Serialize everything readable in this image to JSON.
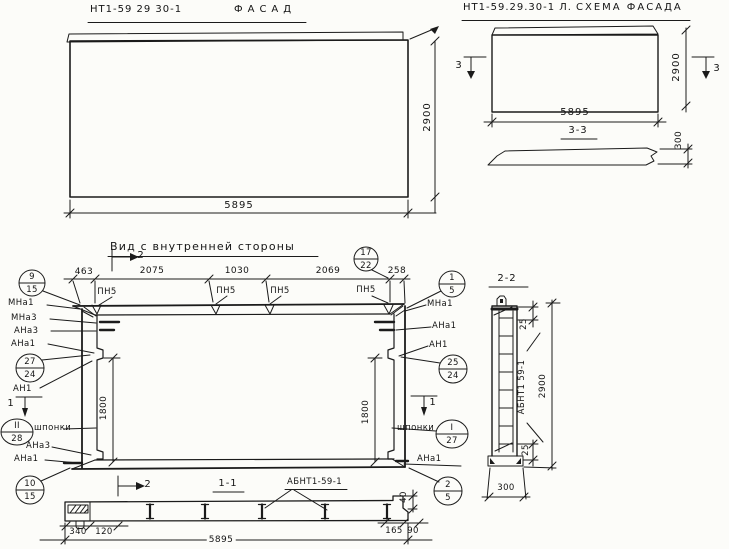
{
  "facade": {
    "code": "НТ1-59 29 30-1",
    "title": "ФАСАД",
    "width": "5895",
    "height": "2900"
  },
  "schema": {
    "code": "НТ1-59.29.30-1 Л.",
    "title": "СХЕМА ФАСАДА",
    "width": "5895",
    "height": "2900",
    "thickness": "300",
    "marker": "3",
    "section_title": "3-3"
  },
  "inner": {
    "title": "Вид с внутренней стороны",
    "marker2": "2",
    "marker1": "1",
    "pn": "ПН5",
    "dims": {
      "d463": "463",
      "d2075": "2075",
      "d1030": "1030",
      "d2069": "2069",
      "d258": "258",
      "d1800": "1800"
    },
    "labels": {
      "mna1": "МНа1",
      "mna3": "МНа3",
      "ana3": "АНа3",
      "ana1": "АНа1",
      "an1": "АН1",
      "shponki": "шпонки"
    },
    "callouts": {
      "c9": {
        "t": "9",
        "b": "15"
      },
      "c27": {
        "t": "27",
        "b": "24"
      },
      "c28": {
        "t": "II",
        "b": "28"
      },
      "c10": {
        "t": "10",
        "b": "15"
      },
      "c17": {
        "t": "17",
        "b": "22"
      },
      "c1": {
        "t": "1",
        "b": "5"
      },
      "c25": {
        "t": "25",
        "b": "24"
      },
      "c127": {
        "t": "I",
        "b": "27"
      },
      "c2": {
        "t": "2",
        "b": "5"
      }
    }
  },
  "sec11": {
    "title": "1-1",
    "label": "АБНТ1-59-1",
    "d340": "340",
    "d120": "120",
    "d5895": "5895",
    "d165": "165",
    "d90": "90",
    "d40": "40"
  },
  "sec22": {
    "title": "2-2",
    "label": "АБНТ1 59-1",
    "d2900": "2900",
    "d25": "25",
    "d300": "300"
  }
}
